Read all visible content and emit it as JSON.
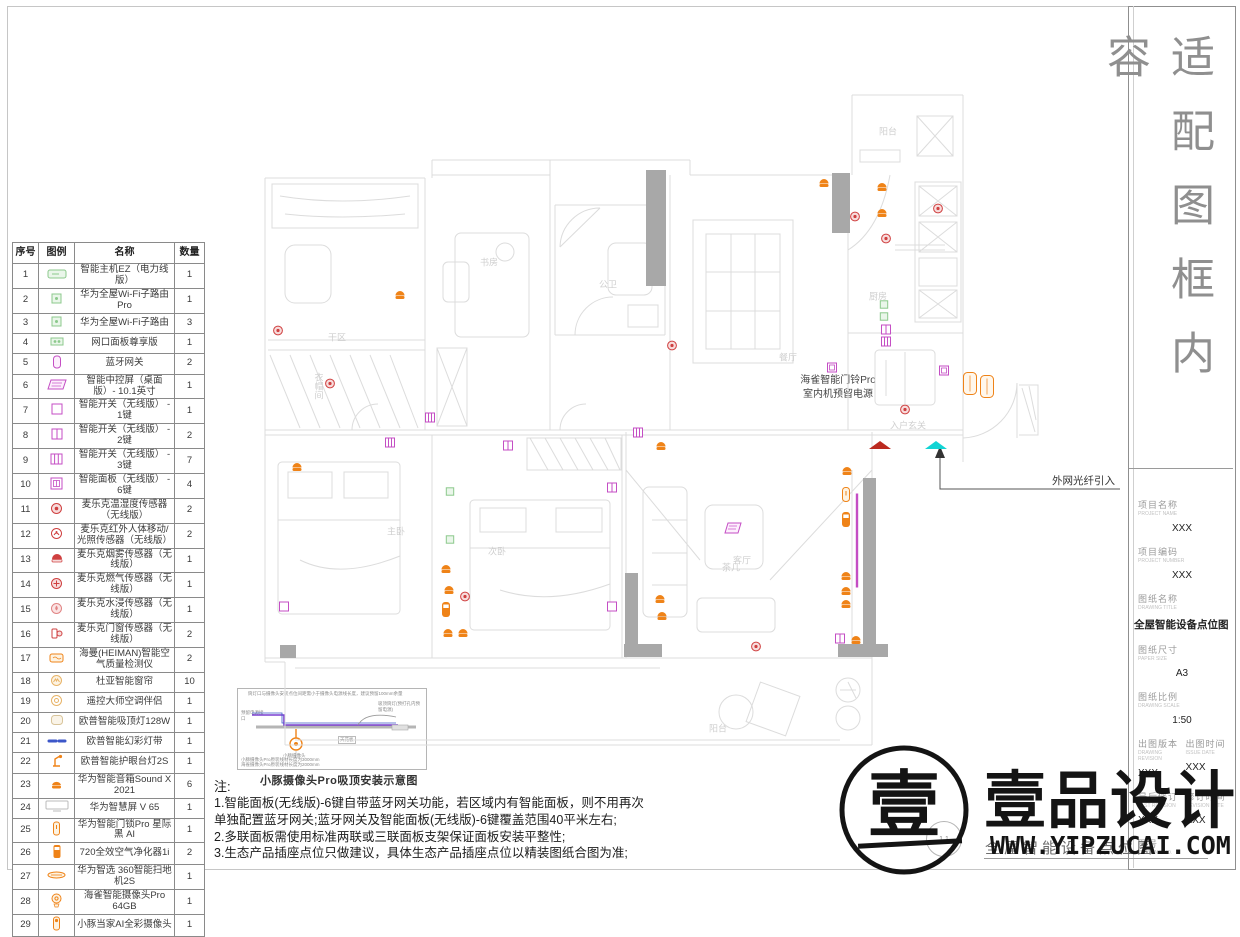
{
  "sheet": {
    "side_title": "适配图框内容"
  },
  "colors": {
    "orange": "#ef8318",
    "red": "#cf4040",
    "red_fill": "#f7dcdc",
    "magenta": "#c44ec4",
    "green": "#8cc98c",
    "cyan": "#12d4d4",
    "darkred": "#bb2a20",
    "cable_purple": "#7a3fd0",
    "strip_blue": "#3c57c9",
    "wall_gray": "#a8a8a8",
    "plan_line": "#dcdcdc"
  },
  "legend_table": {
    "headers": [
      "序号",
      "图例",
      "名称",
      "数量"
    ],
    "rows": [
      {
        "no": "1",
        "icon": "host",
        "name": "智能主机EZ（电力线版）",
        "qty": "1"
      },
      {
        "no": "2",
        "icon": "router",
        "name": "华为全屋Wi-Fi子路由 Pro",
        "qty": "1"
      },
      {
        "no": "3",
        "icon": "router",
        "name": "华为全屋Wi-Fi子路由",
        "qty": "3"
      },
      {
        "no": "4",
        "icon": "netpanel",
        "name": "网口面板尊享版",
        "qty": "1"
      },
      {
        "no": "5",
        "icon": "btgw",
        "name": "蓝牙网关",
        "qty": "2"
      },
      {
        "no": "6",
        "icon": "ctrlscr",
        "name": "智能中控屏（桌面版）- 10.1英寸",
        "qty": "1"
      },
      {
        "no": "7",
        "icon": "sw1",
        "name": "智能开关（无线版） - 1键",
        "qty": "1"
      },
      {
        "no": "8",
        "icon": "sw2",
        "name": "智能开关（无线版） - 2键",
        "qty": "2"
      },
      {
        "no": "9",
        "icon": "sw3",
        "name": "智能开关（无线版） - 3键",
        "qty": "7"
      },
      {
        "no": "10",
        "icon": "panel6",
        "name": "智能面板（无线版） - 6键",
        "qty": "4"
      },
      {
        "no": "11",
        "icon": "temp",
        "name": "麦乐克温湿度传感器（无线版）",
        "qty": "2"
      },
      {
        "no": "12",
        "icon": "motion",
        "name": "麦乐克红外人体移动/光照传感器（无线版）",
        "qty": "2"
      },
      {
        "no": "13",
        "icon": "smoke",
        "name": "麦乐克烟雾传感器（无线版）",
        "qty": "1"
      },
      {
        "no": "14",
        "icon": "gas",
        "name": "麦乐克燃气传感器（无线版）",
        "qty": "1"
      },
      {
        "no": "15",
        "icon": "water",
        "name": "麦乐克水浸传感器（无线版）",
        "qty": "1"
      },
      {
        "no": "16",
        "icon": "doorsen",
        "name": "麦乐克门窗传感器（无线版）",
        "qty": "2"
      },
      {
        "no": "17",
        "icon": "airq",
        "name": "海曼(HEIMAN)智能空气质量检测仪",
        "qty": "2"
      },
      {
        "no": "18",
        "icon": "curtain",
        "name": "杜亚智能窗帘",
        "qty": "10"
      },
      {
        "no": "19",
        "icon": "ircomp",
        "name": "遥控大师空调伴侣",
        "qty": "1"
      },
      {
        "no": "20",
        "icon": "ceillamp",
        "name": "欧普智能吸顶灯128W",
        "qty": "1"
      },
      {
        "no": "21",
        "icon": "strip",
        "name": "欧普智能幻彩灯带",
        "qty": "1"
      },
      {
        "no": "22",
        "icon": "desklamp",
        "name": "欧普智能护眼台灯2S",
        "qty": "1"
      },
      {
        "no": "23",
        "icon": "speaker",
        "name": "华为智能音箱Sound X 2021",
        "qty": "6"
      },
      {
        "no": "24",
        "icon": "tv",
        "name": "华为智慧屏 V 65",
        "qty": "1"
      },
      {
        "no": "25",
        "icon": "lock",
        "name": "华为智能门锁Pro 星际黑 AI",
        "qty": "1"
      },
      {
        "no": "26",
        "icon": "purifier",
        "name": "720全效空气净化器1i",
        "qty": "2"
      },
      {
        "no": "27",
        "icon": "vacuum",
        "name": "华为智选 360智能扫地机2S",
        "qty": "1"
      },
      {
        "no": "28",
        "icon": "cam",
        "name": "海雀智能摄像头Pro 64GB",
        "qty": "1"
      },
      {
        "no": "29",
        "icon": "cam2",
        "name": "小豚当家AI全彩摄像头",
        "qty": "1"
      }
    ]
  },
  "annotations": {
    "doorbell_line1": "海雀智能门铃Pro",
    "doorbell_line2": "室内机预留电源",
    "fiber": "外网光纤引入"
  },
  "inset": {
    "top_note": "筒灯口与摄像头安装点位间距需小于摄像头电源线长度，建议预留100mm余量",
    "left_note": "预留电源接口",
    "right_note": "吸顶筒灯(预打孔内预留电源)",
    "ceiling_label": "天花板",
    "camera_label": "小豚摄像头",
    "bottom_note_1": "小豚摄像头Pro原装线材长度为3000mm",
    "bottom_note_2": "海雀摄像头Pro原装线材长度为2000mm",
    "caption": "小豚摄像头Pro吸顶安装示意图"
  },
  "notes": {
    "heading": "注:",
    "items": [
      "1.智能面板(无线版)-6键自带蓝牙网关功能，若区域内有智能面板，则不用再次单独配置蓝牙网关;蓝牙网关及智能面板(无线版)-6键覆盖范围40平米左右;",
      "2.多联面板需使用标准两联或三联面板支架保证面板安装平整性;",
      "3.生态产品插座点位只做建议，具体生态产品插座点位以精装图纸合图为准;"
    ]
  },
  "title_block": {
    "fields": [
      {
        "label": "项目名称",
        "sub": "PROJECT NAME",
        "value": "XXX"
      },
      {
        "label": "项目编码",
        "sub": "PROJECT NUMBER",
        "value": "XXX"
      },
      {
        "label": "图纸名称",
        "sub": "DRAWING TITLE",
        "value": "全屋智能设备点位图",
        "big": true
      },
      {
        "label": "图纸尺寸",
        "sub": "PAPER SIZE",
        "value": "A3"
      },
      {
        "label": "图纸比例",
        "sub": "DRAWING SCALE",
        "value": "1:50"
      }
    ],
    "pairs": [
      [
        {
          "label": "出图版本",
          "sub": "DRAWING REVISION",
          "value": "XXX"
        },
        {
          "label": "出图时间",
          "sub": "ISSUE DATE",
          "value": "XXX"
        }
      ],
      [
        {
          "label": "最后修订",
          "sub": "LAST REVISION",
          "value": "XXX"
        },
        {
          "label": "修订时间",
          "sub": "REVISION DATE",
          "value": "XXX"
        }
      ]
    ],
    "drawing_no_label": "图号",
    "drawing_no_sub": "DRAWING NO."
  },
  "footer": {
    "bubble": "1.1",
    "drawing_title": "全屋智能设备点位图"
  },
  "watermark": {
    "brand": "壹品设计",
    "url": "WWW.YIPZUCAI.COM",
    "logo_char": "壹"
  },
  "rooms": [
    {
      "t": "阳台",
      "x": 888,
      "y": 131
    },
    {
      "t": "厨房",
      "x": 878,
      "y": 296
    },
    {
      "t": "书房",
      "x": 489,
      "y": 262
    },
    {
      "t": "公卫",
      "x": 608,
      "y": 284
    },
    {
      "t": "餐厅",
      "x": 788,
      "y": 357
    },
    {
      "t": "入户玄关",
      "x": 908,
      "y": 425
    },
    {
      "t": "客厅",
      "x": 742,
      "y": 560
    },
    {
      "t": "主卧",
      "x": 396,
      "y": 531
    },
    {
      "t": "次卧",
      "x": 497,
      "y": 551
    },
    {
      "t": "阳台",
      "x": 718,
      "y": 728
    },
    {
      "t": "干区",
      "x": 337,
      "y": 337
    },
    {
      "t": "茶几",
      "x": 731,
      "y": 567
    },
    {
      "t": "衣帽间",
      "x": 319,
      "y": 386,
      "v": 1
    }
  ],
  "devices": [
    {
      "s": "spk",
      "x": 400,
      "y": 296
    },
    {
      "s": "spk",
      "x": 824,
      "y": 184
    },
    {
      "s": "spk",
      "x": 882,
      "y": 188
    },
    {
      "s": "spk",
      "x": 882,
      "y": 214
    },
    {
      "s": "grn",
      "x": 884,
      "y": 305
    },
    {
      "s": "grn",
      "x": 884,
      "y": 317
    },
    {
      "s": "sq",
      "x": 886,
      "y": 331,
      "k": 2
    },
    {
      "s": "sq",
      "x": 886,
      "y": 343,
      "k": 3
    },
    {
      "s": "dot",
      "x": 855,
      "y": 218
    },
    {
      "s": "dot",
      "x": 886,
      "y": 240
    },
    {
      "s": "dot",
      "x": 938,
      "y": 210
    },
    {
      "s": "dot",
      "x": 278,
      "y": 332
    },
    {
      "s": "dot",
      "x": 330,
      "y": 385
    },
    {
      "s": "dot",
      "x": 672,
      "y": 347
    },
    {
      "s": "sq",
      "x": 430,
      "y": 419,
      "k": 3
    },
    {
      "s": "sq",
      "x": 390,
      "y": 444,
      "k": 3
    },
    {
      "s": "sq",
      "x": 508,
      "y": 447,
      "k": 2
    },
    {
      "s": "grn",
      "x": 450,
      "y": 492
    },
    {
      "s": "grn",
      "x": 450,
      "y": 540
    },
    {
      "s": "spk",
      "x": 446,
      "y": 570
    },
    {
      "s": "spk",
      "x": 449,
      "y": 591
    },
    {
      "s": "cyl",
      "x": 446,
      "y": 612
    },
    {
      "s": "spk",
      "x": 448,
      "y": 634
    },
    {
      "s": "spk",
      "x": 463,
      "y": 634
    },
    {
      "s": "dot",
      "x": 465,
      "y": 598
    },
    {
      "s": "sq",
      "x": 284,
      "y": 608,
      "k": 1
    },
    {
      "s": "sq",
      "x": 612,
      "y": 489,
      "k": 2
    },
    {
      "s": "sq",
      "x": 612,
      "y": 608,
      "k": 1
    },
    {
      "s": "spk",
      "x": 297,
      "y": 468
    },
    {
      "s": "sq",
      "x": 638,
      "y": 434,
      "k": 3
    },
    {
      "s": "spk",
      "x": 661,
      "y": 447
    },
    {
      "s": "spk",
      "x": 660,
      "y": 600
    },
    {
      "s": "spk",
      "x": 662,
      "y": 617
    },
    {
      "s": "scr",
      "x": 733,
      "y": 530
    },
    {
      "s": "sq",
      "x": 832,
      "y": 369,
      "k": 6
    },
    {
      "s": "sq",
      "x": 944,
      "y": 372,
      "k": 6
    },
    {
      "s": "dot",
      "x": 905,
      "y": 411
    },
    {
      "s": "cab",
      "x": 970,
      "y": 386
    },
    {
      "s": "cab",
      "x": 987,
      "y": 389
    },
    {
      "s": "spk",
      "x": 847,
      "y": 472
    },
    {
      "s": "lock",
      "x": 846,
      "y": 497
    },
    {
      "s": "cyl",
      "x": 846,
      "y": 522
    },
    {
      "s": "spk",
      "x": 846,
      "y": 577
    },
    {
      "s": "spk",
      "x": 846,
      "y": 592
    },
    {
      "s": "spk",
      "x": 846,
      "y": 605
    },
    {
      "s": "sq",
      "x": 840,
      "y": 640,
      "k": 2
    },
    {
      "s": "spk",
      "x": 856,
      "y": 641
    },
    {
      "s": "dot",
      "x": 756,
      "y": 648
    },
    {
      "s": "vline",
      "x": 857,
      "y": 543,
      "h": 94
    },
    {
      "s": "tri",
      "x": 880,
      "y": 446,
      "c": "darkred"
    },
    {
      "s": "tri",
      "x": 936,
      "y": 446,
      "c": "cyan"
    }
  ]
}
